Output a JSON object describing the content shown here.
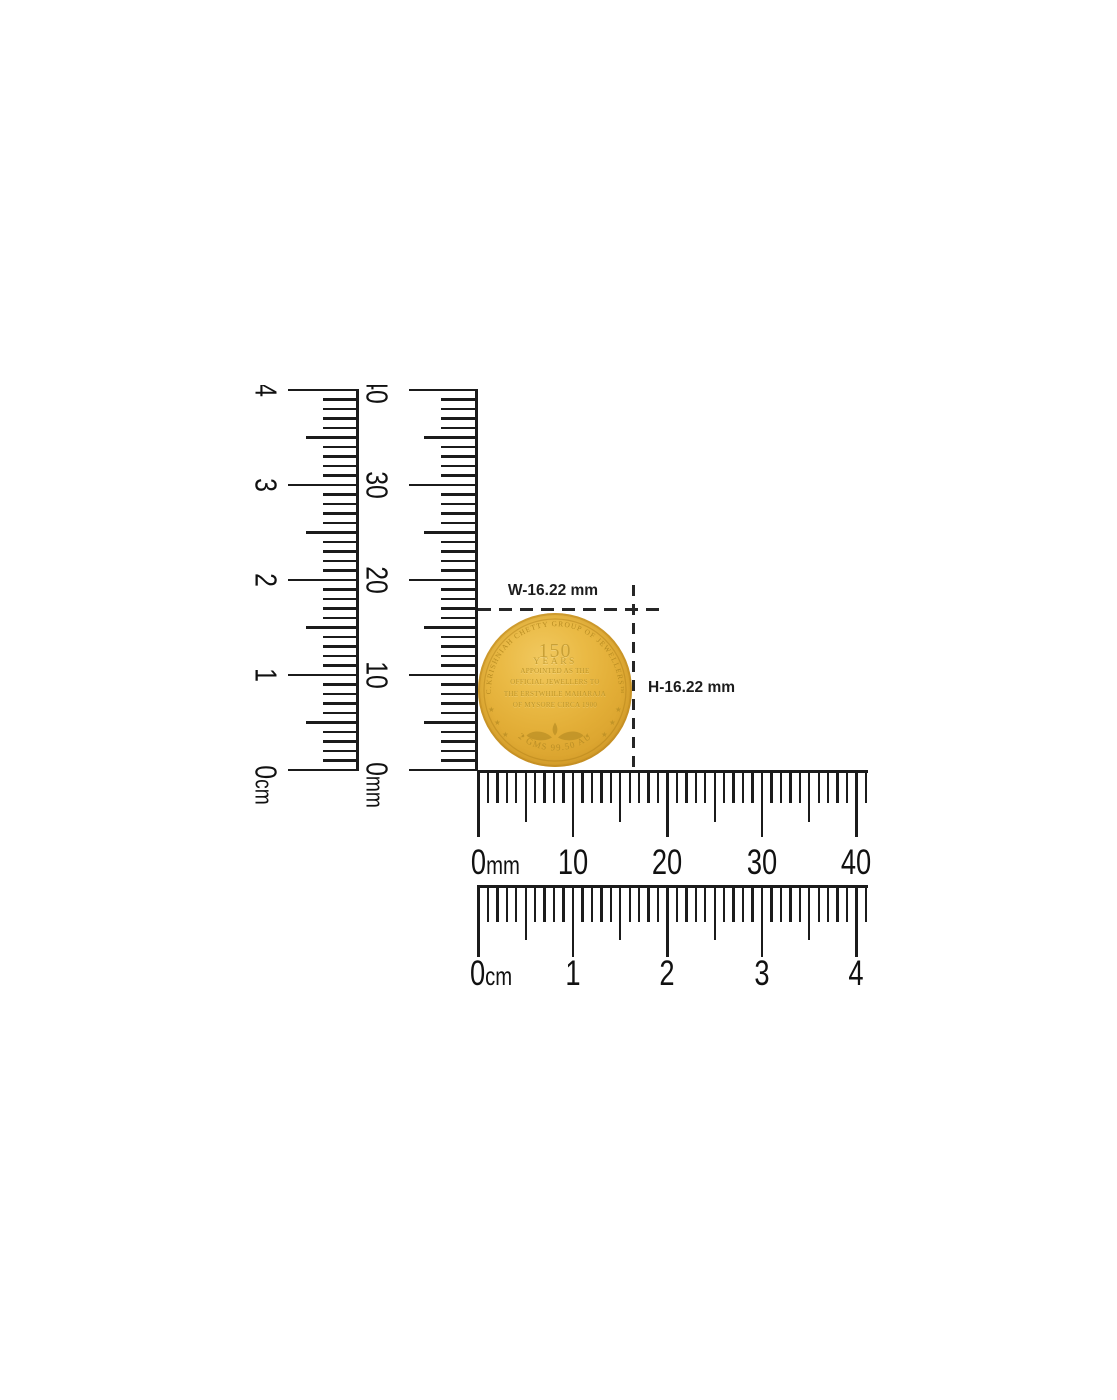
{
  "measurements": {
    "width_label": "W-16.22 mm",
    "height_label": "H-16.22 mm"
  },
  "coin": {
    "edge_text": "C.KRISHNIAH CHETTY GROUP OF JEWELLERS™",
    "value": "150",
    "value_unit": "YEARS",
    "lines": [
      "APPOINTED AS THE",
      "OFFICIAL JEWELLERS TO",
      "THE ERSTWHILE MAHARAJA",
      "OF MYSORE CIRCA 1900"
    ],
    "bottom_text": "2 GMS  99.50  AU",
    "star": "★",
    "colors": {
      "gold_light": "#f1c960",
      "gold": "#e8b640",
      "gold_dark": "#c38d22",
      "engraving": "#b88d22"
    }
  },
  "rulers": {
    "ink": "#1b1b1b",
    "vertical_cm": {
      "unit": "cm",
      "labels": [
        "0",
        "1",
        "2",
        "3",
        "4"
      ]
    },
    "vertical_mm": {
      "unit": "mm",
      "labels": [
        "0",
        "10",
        "20",
        "30",
        "40"
      ]
    },
    "horizontal_mm": {
      "unit": "mm",
      "labels": [
        "0",
        "10",
        "20",
        "30",
        "40"
      ]
    },
    "horizontal_cm": {
      "unit": "cm",
      "labels": [
        "0",
        "1",
        "2",
        "3",
        "4"
      ]
    }
  }
}
